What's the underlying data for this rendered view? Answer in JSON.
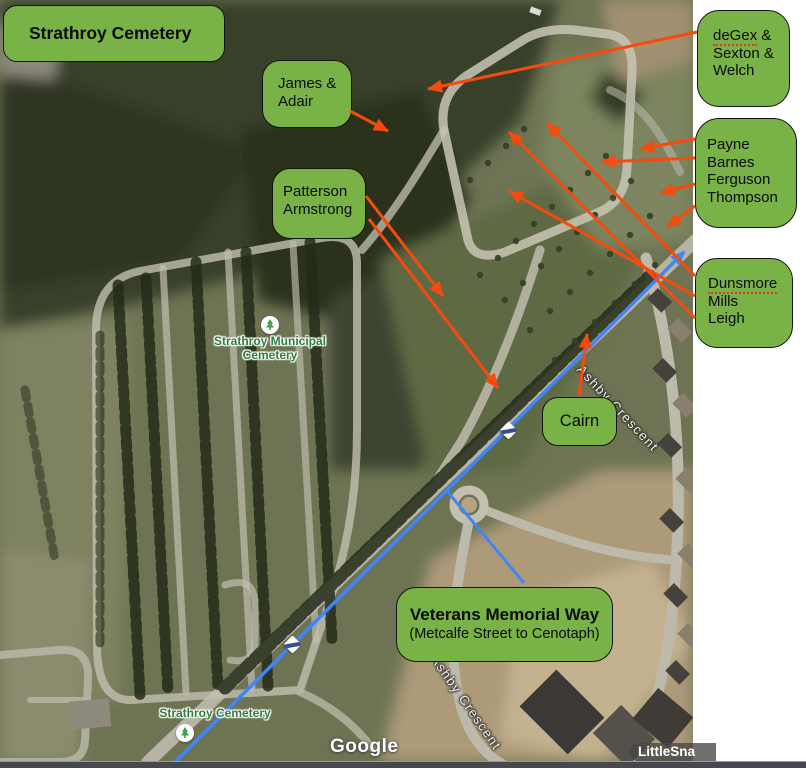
{
  "colors": {
    "box_green": "#79b247",
    "arrow_orange": "#f64a0e",
    "route_blue": "#4285f4"
  },
  "overlays": {
    "title": "Strathroy Cemetery",
    "james_adair": {
      "line1": "James &",
      "line2": "Adair"
    },
    "patterson_armstrong": {
      "line1": "Patterson",
      "line2": "Armstrong"
    },
    "cairn": "Cairn",
    "veterans": {
      "title": "Veterans Memorial Way",
      "subtitle": "(Metcalfe Street to Cenotaph)"
    }
  },
  "side_panel": {
    "degex": {
      "word": "deGex",
      "suffix": " &",
      "line2": "Sexton &",
      "line3": "Welch"
    },
    "payne": {
      "line1": "Payne",
      "line2": "Barnes",
      "line3": "Ferguson",
      "line4": "Thompson"
    },
    "dunsmore": {
      "word": "Dunsmore",
      "line2": "Mills",
      "line3": "Leigh"
    }
  },
  "map_labels": {
    "municipal_line1": "Strathroy Municipal",
    "municipal_line2": "Cemetery",
    "cemetery_label": "Strathroy Cemetery",
    "street_top": "Ashby Crescent",
    "street_bottom": "Ashby Crescent",
    "google_logo": "Google",
    "snapper_watermark": "LittleSna"
  }
}
